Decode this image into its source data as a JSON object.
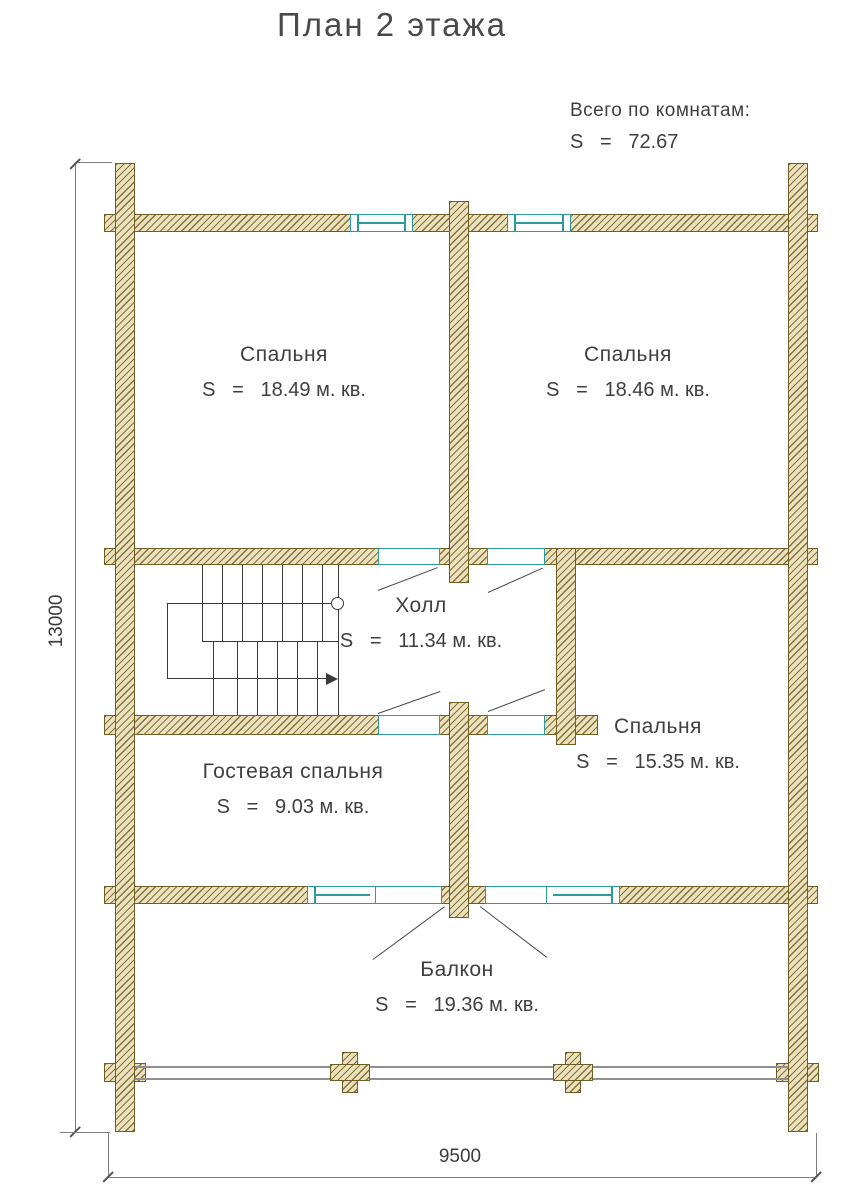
{
  "title": "План 2 этажа",
  "total": {
    "label": "Всего по комнатам:",
    "value": "S   =   72.67"
  },
  "rooms": [
    {
      "name": "Спальня",
      "area": "S   =   18.49 м. кв."
    },
    {
      "name": "Спальня",
      "area": "S   =   18.46 м. кв."
    },
    {
      "name": "Холл",
      "area": "S   =   11.34 м. кв."
    },
    {
      "name": "Спальня",
      "area": "S   =   15.35 м. кв."
    },
    {
      "name": "Гостевая спальня",
      "area": "S   =   9.03 м. кв."
    },
    {
      "name": "Балкон",
      "area": "S   =   19.36 м. кв."
    }
  ],
  "dimensions": {
    "left": "13000",
    "bottom": "9500"
  },
  "colors": {
    "wall_fill": "#ece1bd",
    "wall_outline": "#6e5d24",
    "window_accent": "#2d9b99",
    "drawing_line": "#3a3a3a",
    "dimension_line": "#7d7d7d",
    "railing": "#909090",
    "text": "#3f3f3f"
  }
}
